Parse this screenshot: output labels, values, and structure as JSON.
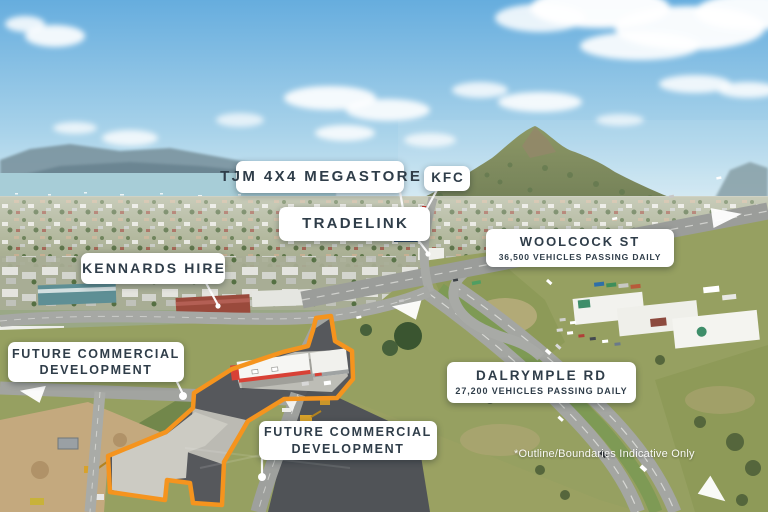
{
  "callouts": {
    "tjm": "TJM 4X4 MEGASTORE",
    "kfc": "KFC",
    "tradelink": "TRADELINK",
    "kennards": "KENNARDS HIRE",
    "woolcock": {
      "title": "WOOLCOCK ST",
      "subtitle": "36,500 VEHICLES PASSING DAILY"
    },
    "dalrymple": {
      "title": "DALRYMPLE RD",
      "subtitle": "27,200 VEHICLES PASSING DAILY"
    },
    "future_left": {
      "line1": "FUTURE COMMERCIAL",
      "line2": "DEVELOPMENT"
    },
    "future_bottom": {
      "line1": "FUTURE COMMERCIAL",
      "line2": "DEVELOPMENT"
    }
  },
  "disclaimer": "*Outline/Boundaries Indicative Only",
  "colors": {
    "boundary_outline": "#F5941E",
    "callout_bg": "#FFFFFF",
    "callout_text": "#2F3D49",
    "annotation": "#FFFFFF"
  }
}
